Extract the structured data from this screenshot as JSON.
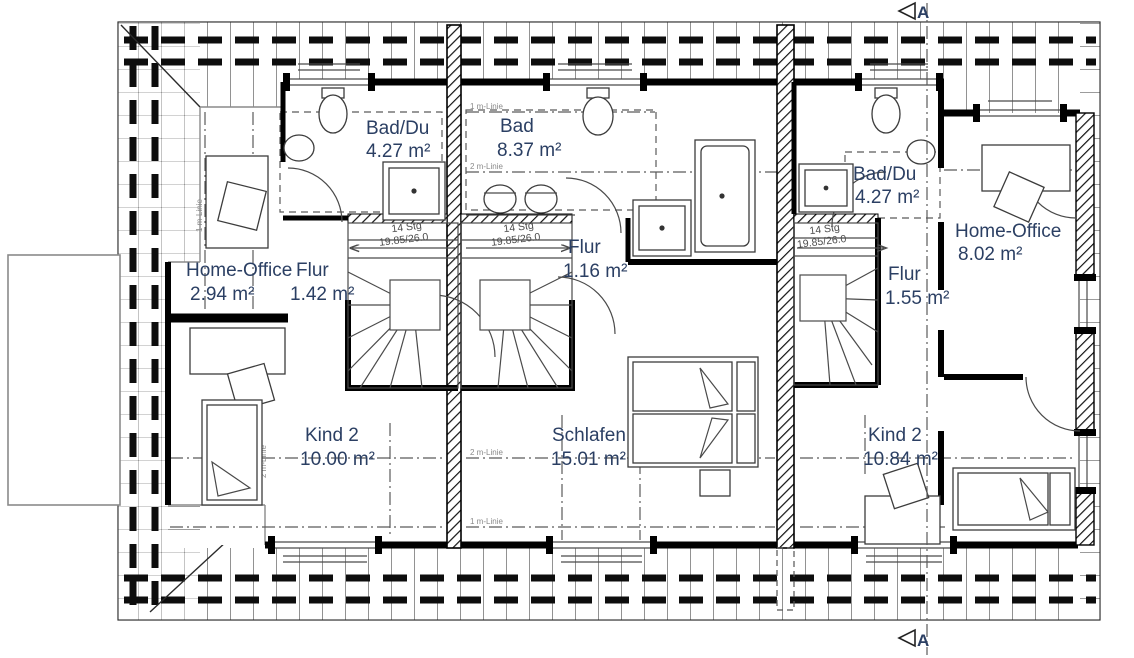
{
  "plan": {
    "section_marker": "A",
    "stair": {
      "steps": "14 Stg",
      "dimensions": "19.85/26.0"
    },
    "height_lines": {
      "one": "1 m-Linie",
      "two": "2 m-Linie"
    },
    "rooms": [
      {
        "name": "Bad/Du",
        "area": "4.27 m²"
      },
      {
        "name": "Bad",
        "area": "8.37 m²"
      },
      {
        "name": "Home-Office",
        "area": "2.94 m²"
      },
      {
        "name": "Flur",
        "area": "1.42 m²"
      },
      {
        "name": "Flur",
        "area": "1.16 m²"
      },
      {
        "name": "Kind 2",
        "area": "10.00 m²"
      },
      {
        "name": "Schlafen",
        "area": "15.01 m²"
      },
      {
        "name": "Bad/Du",
        "area": "4.27 m²"
      },
      {
        "name": "Flur",
        "area": "1.55 m²"
      },
      {
        "name": "Home-Office",
        "area": "8.02 m²"
      },
      {
        "name": "Kind 2",
        "area": "10.84 m²"
      }
    ],
    "colors": {
      "label": "#2b3f63",
      "wall": "#000000",
      "paper": "#ffffff"
    }
  }
}
